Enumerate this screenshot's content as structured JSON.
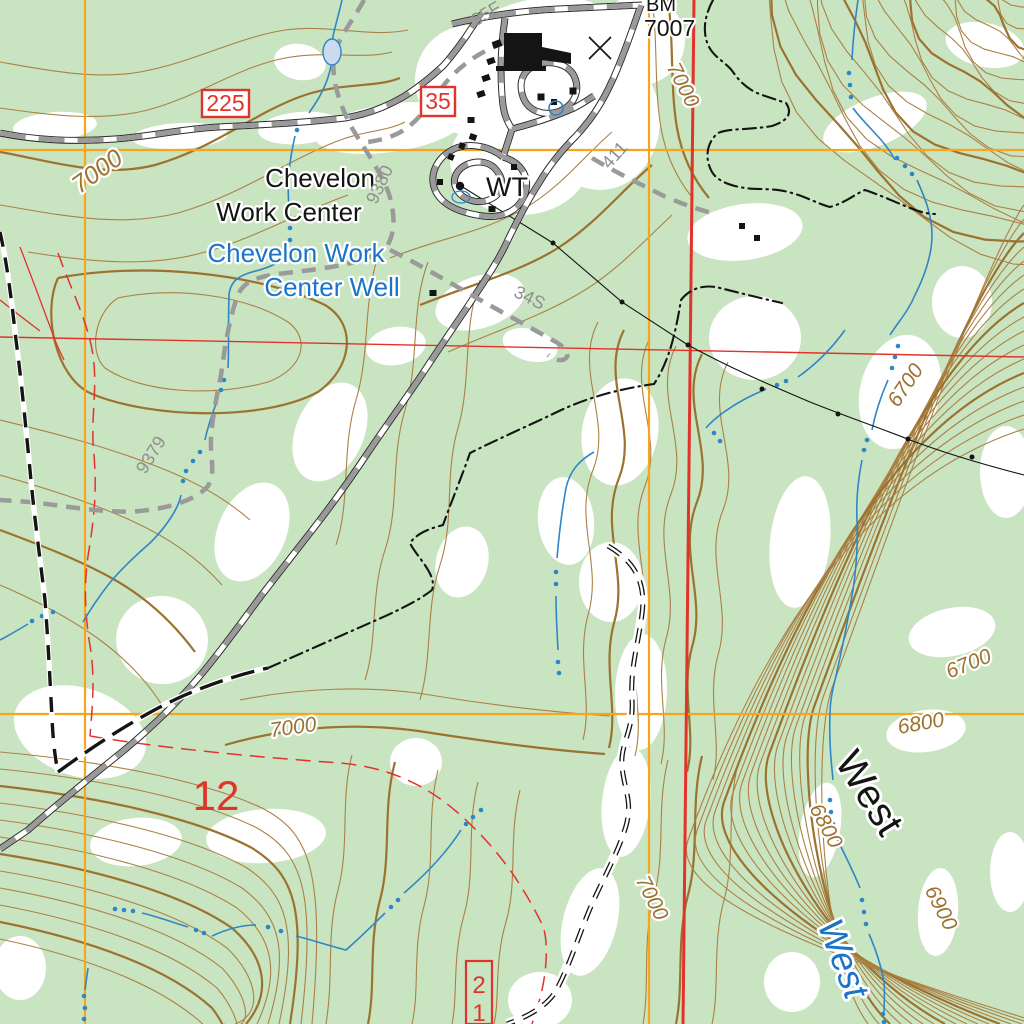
{
  "map_labels": {
    "route_225": "225",
    "route_35": "35",
    "route_21_top": "2",
    "route_21_bottom": "1",
    "section_12": "12",
    "benchmark_abbr": "BM",
    "benchmark_elev": "7007",
    "work_center_line1": "Chevelon",
    "work_center_line2": "Work Center",
    "well_line1": "Chevelon Work",
    "well_line2": "Center Well",
    "water_tank": "WT",
    "canyon_name": "West",
    "stream_name": "West",
    "road_35f": "35F",
    "road_9380": "9380",
    "road_9379": "9379",
    "road_411": "411",
    "road_34s": "34S"
  },
  "contour_labels": {
    "nw_7000": "7000",
    "ne_7000": "7000",
    "s_7000": "7000",
    "se_7000": "7000",
    "e_6700_upper": "6700",
    "e_6700_lower": "6700",
    "e_6800_upper": "6800",
    "e_6800_lower": "6800",
    "e_6900": "6900"
  },
  "colors": {
    "forest_green": "#c9e4c1",
    "clearing_white": "#ffffff",
    "contour_brown": "#ab8045",
    "contour_index_brown": "#9c7231",
    "grid_orange": "#f7a51e",
    "section_red": "#e2332b",
    "water_blue": "#2f86c6",
    "road_gray": "#9a9a9a",
    "feature_black": "#141414"
  }
}
